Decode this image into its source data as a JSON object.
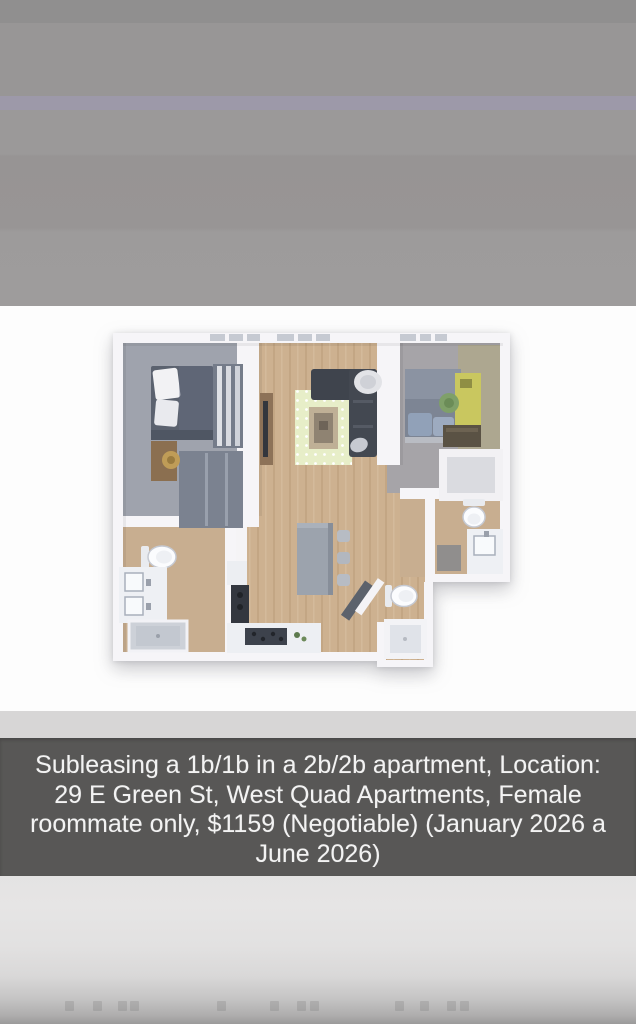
{
  "window": {
    "width": 636,
    "height": 1024
  },
  "caption": {
    "full_text": "Subleasing a 1b/1b in a 2b/2b apartment, Location: 29 E Green St, West Quad Apartments, Female roommate only, $1159 (Negotiable) (January 2026 a June 2026)",
    "lines": [
      "Subleasing a 1b/1b in a 2b/2b apartment, Location:",
      "29 E Green St, West Quad Apartments, Female",
      "roommate only, $1159 (Negotiable) (January 2026 a",
      "June 2026)"
    ]
  },
  "floor_plan": {
    "type": "3d-rendered top-down apartment floor plan",
    "rooms": [
      "bedroom-left",
      "bathroom-left",
      "living-dining-kitchen",
      "entry-hall-bathroom-2",
      "bedroom-right",
      "walk-in-closet"
    ]
  },
  "palette": {
    "top_band_dark": "#908f8f",
    "top_background": "#989696",
    "purple_band": "#9d99a9",
    "photo_background": "#fdfdfd",
    "pre_caption_band": "#d7d6d6",
    "caption_background": "#585756",
    "caption_text": "#f3f3f3",
    "bottom_background": "#e4e3e3",
    "wall": "#f6f5f8",
    "wood_floor": "#cdb190",
    "bedroom_floor": "#9fa3ad",
    "bath_floor": "#c8ae90",
    "rug": "#e7eec8",
    "sofa": "#3f444d",
    "desk_yellow": "#c9c75f",
    "chair_green": "#7fa069"
  }
}
